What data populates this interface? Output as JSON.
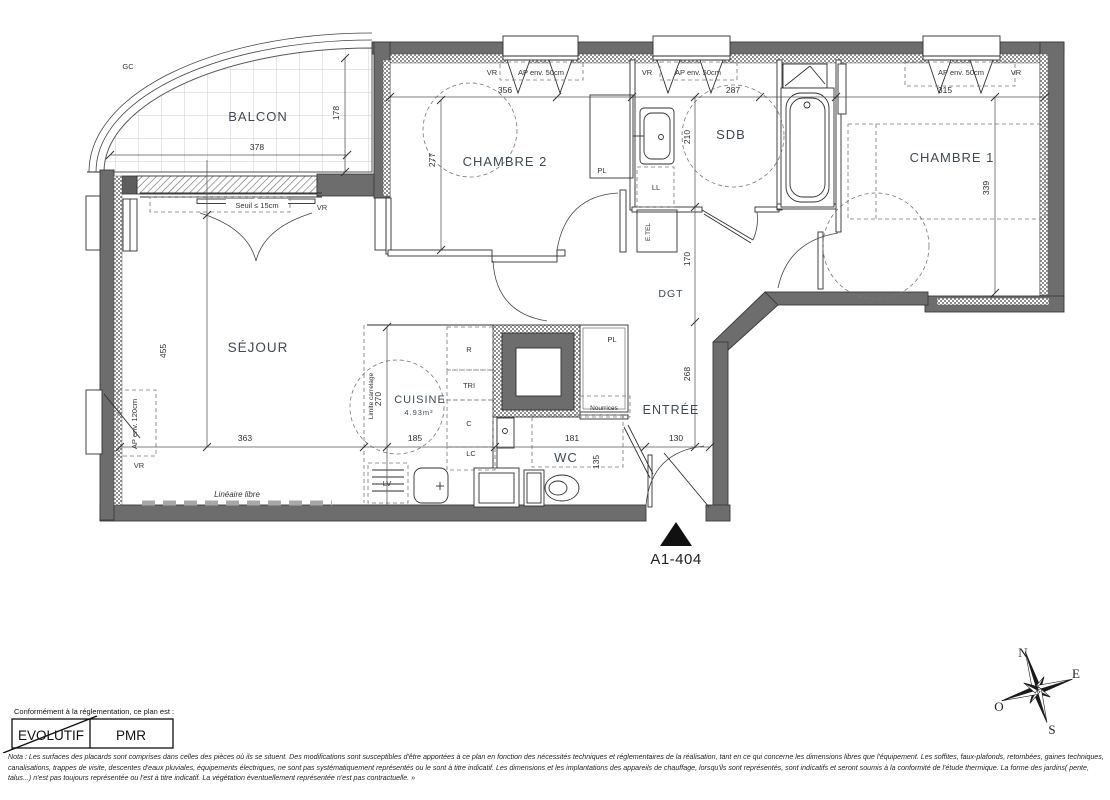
{
  "unit_id": "A1-404",
  "rooms": {
    "balcon": "BALCON",
    "sejour": "SÉJOUR",
    "chambre2": "CHAMBRE 2",
    "chambre1": "CHAMBRE 1",
    "sdb": "SDB",
    "dgt": "DGT",
    "entree": "ENTRÉE",
    "wc": "WC",
    "cuisine": "CUISINE",
    "cuisine_area": "4.93m²"
  },
  "dims": {
    "balcon_w": "378",
    "balcon_d": "178",
    "sejour_h": "455",
    "sejour_w": "363",
    "ch2_w": "356",
    "ch2_d": "277",
    "sdb_w": "287",
    "sdb_d": "210",
    "ch1_w": "315",
    "ch1_d": "339",
    "dgt_d": "170",
    "entree_d": "268",
    "entree_w": "130",
    "wc_w": "181",
    "wc_d": "135",
    "cuisine_w": "185",
    "cuisine_d": "270"
  },
  "labels": {
    "gc": "GC",
    "vr": "VR",
    "ap50": "AP env. 50cm",
    "ap120": "AP env. 120cm",
    "seuil": "Seuil ≤ 15cm",
    "pl": "PL",
    "ll": "LL",
    "etel": "E.TEL",
    "lv": "LV",
    "r": "R",
    "tri": "TRI",
    "c": "C",
    "lc": "LC",
    "nourrices": "Nourrices",
    "lineaire": "Linéaire libre",
    "limite": "Limite carrelage"
  },
  "compass": {
    "n": "N",
    "e": "E",
    "s": "S",
    "o": "O"
  },
  "legend": {
    "intro": "Conformément à la réglementation, ce plan est :",
    "evolutif": "EVOLUTIF",
    "pmr": "PMR"
  },
  "nota": "Nota : Les surfaces des placards sont comprises dans celles des pièces où ils se situent. Des modifications sont susceptibles d'être apportées à ce plan en fonction des nécessités techniques et réglementaires de la réalisation, tant en ce qui concerne les dimensions libres que l'équipement.  Les soffites, faux-plafonds, retombées, gaines techniques, canalisations, trappes de visite, descentes d'eaux pluviales, équipements électriques, ne sont pas systématiquement représentés ou le sont à titre indicatif. Les dimensions et les implantations des appareils de chauffage, lorsqu'ils sont représentés, sont indicatifs et seront soumis à la conformité de l'étude thermique. La forme des jardins( pente, talus...) n'est pas toujours représentée ou l'est à titre indicatif. La végétation éventuellement représentée n'est pas contractuelle. »"
}
